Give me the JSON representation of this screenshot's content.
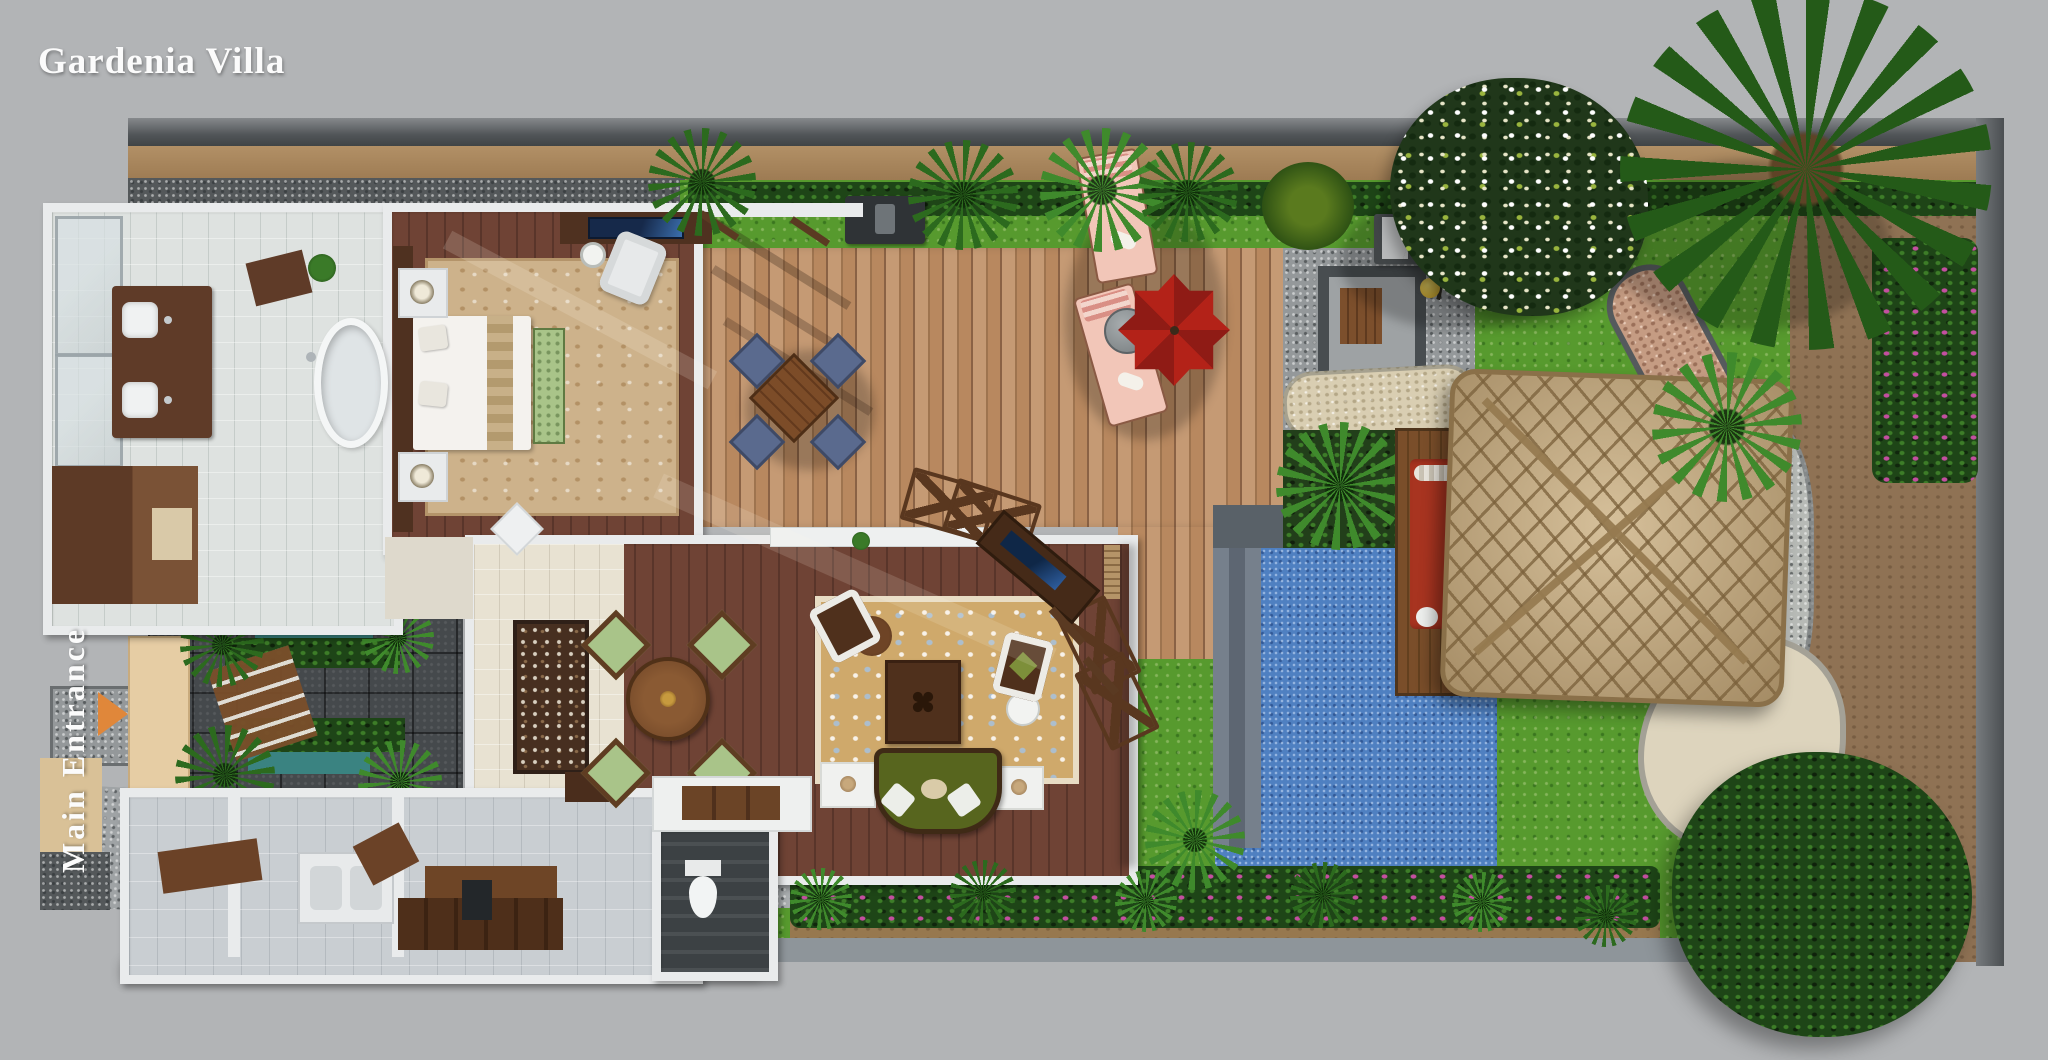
{
  "header": {
    "title": "Gardenia Villa"
  },
  "entrance": {
    "label": "Main Entrance",
    "arrow_icon": "right-arrow-icon"
  },
  "colors": {
    "bg": "#b2b4b6",
    "wall_dark": "#4e5254",
    "wall_tan": "#ab8a60",
    "wall_white": "#e9ebec",
    "grass": "#579a2e",
    "hedge_dark": "#1e4517",
    "deck_wood": "#bb8f6a",
    "wood_floor": "#6b4136",
    "tile": "#dee2e0",
    "pool_blue": "#4f80c1",
    "pool_step": "#747e8a",
    "thatch": "#c4a97e",
    "dirt": "#8f7254",
    "sand": "#ddd4bd",
    "pond_teal": "#3a8381",
    "umbrella_red": "#a81f16",
    "lounger_pink": "#f2c6b8",
    "daybed_red": "#a83420",
    "sofa_green": "#57651e",
    "chair_sage": "#a9c489",
    "chair_navy": "#5a6a8e",
    "carpet_beige": "#cdb28b",
    "rug_tan": "#cfa96b",
    "stone_court": "#45494c",
    "arrow_orange": "#e0873a",
    "title_white": "#fbfbfb"
  }
}
